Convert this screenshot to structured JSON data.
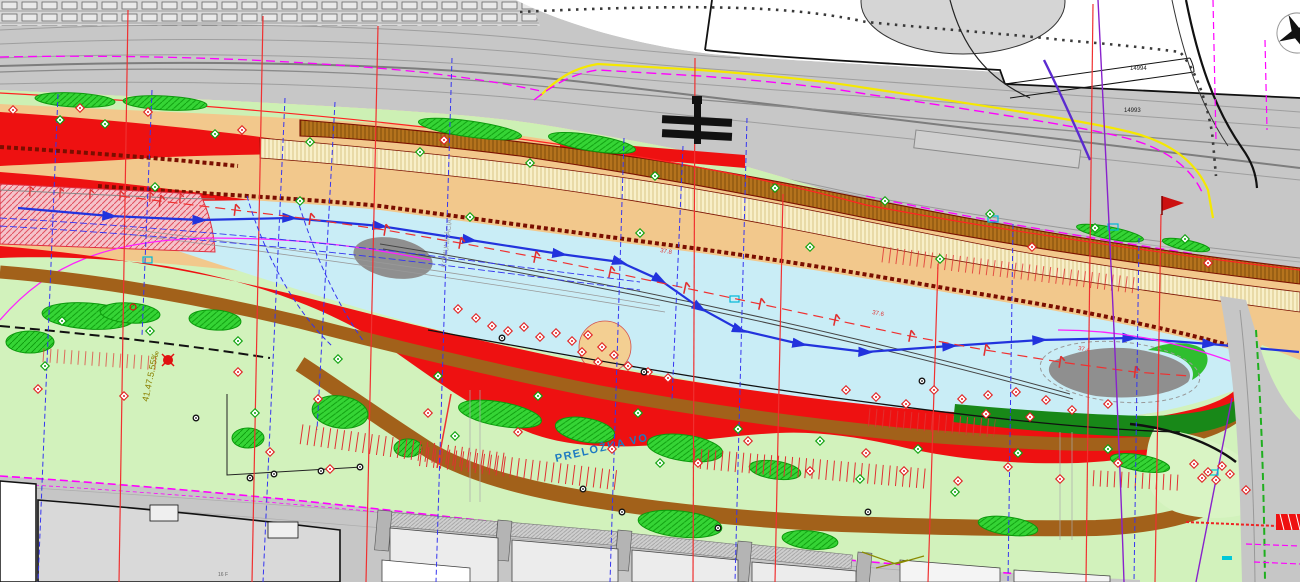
{
  "drawing": {
    "type": "riverside-site-plan",
    "labels": {
      "gradient": "41.47.5.55‰",
      "lighting_relocation": "PRELOŽKA VO",
      "road_name": "KOMUNIKÁCIA",
      "parcel_upper": "14994",
      "parcel_lower": "14993",
      "chainage_1": "37.8",
      "chainage_2": "37.6",
      "chainage_3": "37.4",
      "building_label": "16 F"
    },
    "palette": {
      "river": "#c9edf6",
      "park": "#d2f2bc",
      "tree_green": "#35d435",
      "tan": "#f2c88c",
      "pale_hatch": "#f8efc8",
      "brown_hatch": "#b5731d",
      "brown_path": "#a2611a",
      "red": "#ee1111",
      "dark_red": "#7a0e00",
      "dark_green": "#188818",
      "pink_zone": "#f5c3ca",
      "rail_gray": "#c7c7c7",
      "road_gray": "#c6c6c6",
      "building_gray": "#d9d9d9",
      "shoal_gray": "#8f8f8f",
      "magenta": "#ff00ff",
      "yellow": "#f5e800",
      "flow_blue": "#2233dd",
      "section_blue": "#3535f0",
      "section_red": "#f03030",
      "purple": "#8822cc",
      "olive_text": "#8a8000",
      "label_blue": "#1d7ac2",
      "cyan": "#00b8d8"
    }
  },
  "markers": {
    "felled_trees": [
      [
        13,
        110
      ],
      [
        80,
        108
      ],
      [
        148,
        112
      ],
      [
        242,
        130
      ],
      [
        444,
        140
      ],
      [
        1032,
        247
      ],
      [
        1208,
        263
      ],
      [
        458,
        309
      ],
      [
        476,
        318
      ],
      [
        492,
        326
      ],
      [
        508,
        331
      ],
      [
        524,
        327
      ],
      [
        540,
        337
      ],
      [
        556,
        333
      ],
      [
        572,
        341
      ],
      [
        588,
        335
      ],
      [
        602,
        347
      ],
      [
        614,
        355
      ],
      [
        598,
        362
      ],
      [
        582,
        352
      ],
      [
        628,
        366
      ],
      [
        648,
        372
      ],
      [
        668,
        378
      ],
      [
        846,
        390
      ],
      [
        876,
        397
      ],
      [
        906,
        404
      ],
      [
        934,
        390
      ],
      [
        962,
        399
      ],
      [
        988,
        395
      ],
      [
        1016,
        392
      ],
      [
        1046,
        400
      ],
      [
        986,
        414
      ],
      [
        1030,
        417
      ],
      [
        1072,
        410
      ],
      [
        1108,
        404
      ],
      [
        38,
        389
      ],
      [
        124,
        396
      ],
      [
        238,
        372
      ],
      [
        318,
        399
      ],
      [
        428,
        413
      ],
      [
        518,
        432
      ],
      [
        612,
        449
      ],
      [
        698,
        463
      ],
      [
        748,
        441
      ],
      [
        810,
        471
      ],
      [
        866,
        453
      ],
      [
        904,
        471
      ],
      [
        958,
        481
      ],
      [
        1008,
        467
      ],
      [
        1060,
        479
      ],
      [
        1118,
        463
      ],
      [
        330,
        469
      ],
      [
        270,
        452
      ],
      [
        1194,
        464
      ],
      [
        1208,
        472
      ],
      [
        1222,
        466
      ],
      [
        1216,
        480
      ],
      [
        1202,
        478
      ],
      [
        1230,
        474
      ],
      [
        1246,
        490
      ]
    ],
    "planted_trees": [
      [
        60,
        120
      ],
      [
        105,
        124
      ],
      [
        215,
        134
      ],
      [
        310,
        142
      ],
      [
        420,
        152
      ],
      [
        530,
        163
      ],
      [
        655,
        176
      ],
      [
        775,
        188
      ],
      [
        885,
        201
      ],
      [
        990,
        214
      ],
      [
        1095,
        228
      ],
      [
        1185,
        239
      ],
      [
        155,
        187
      ],
      [
        300,
        201
      ],
      [
        470,
        217
      ],
      [
        640,
        233
      ],
      [
        810,
        247
      ],
      [
        940,
        259
      ],
      [
        62,
        321
      ],
      [
        150,
        331
      ],
      [
        238,
        341
      ],
      [
        338,
        359
      ],
      [
        438,
        376
      ],
      [
        538,
        396
      ],
      [
        638,
        413
      ],
      [
        738,
        429
      ],
      [
        820,
        441
      ],
      [
        918,
        449
      ],
      [
        1018,
        453
      ],
      [
        1108,
        449
      ],
      [
        255,
        413
      ],
      [
        455,
        436
      ],
      [
        660,
        463
      ],
      [
        860,
        479
      ],
      [
        955,
        492
      ],
      [
        45,
        366
      ]
    ],
    "survey_points": [
      [
        196,
        418
      ],
      [
        250,
        478
      ],
      [
        274,
        474
      ],
      [
        321,
        471
      ],
      [
        360,
        467
      ],
      [
        583,
        489
      ],
      [
        622,
        512
      ],
      [
        718,
        528
      ],
      [
        868,
        512
      ],
      [
        502,
        338
      ],
      [
        644,
        372
      ],
      [
        922,
        381
      ]
    ]
  }
}
